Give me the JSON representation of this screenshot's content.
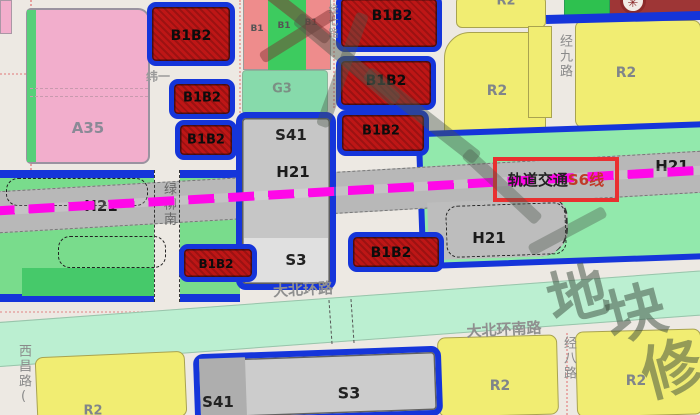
{
  "map_type": "urban-planning-zoning-map",
  "labels": {
    "a35": "A35",
    "b1b2": "B1B2",
    "b1": "B1",
    "g3": "G3",
    "s41": "S41",
    "h21": "H21",
    "s3": "S3",
    "r2": "R2"
  },
  "roads": {
    "wei_yi": "纬一",
    "jing_qi": "经七路",
    "jing_jiu": "经九路",
    "lv_liu": "绿柳南",
    "da_bei_huan": "大北环路",
    "da_bei_huan_nan": "大北环南路",
    "jing_ba": "经八路",
    "xi_chang": "西昌路("
  },
  "transit": {
    "prefix": "轨道交通",
    "line": "S6线"
  },
  "watermark": {
    "char_1": "地",
    "char_2": "块",
    "char_3": "修"
  },
  "icons": {
    "utility": "✳"
  },
  "colors": {
    "parcel_red": "#BE1616",
    "parcel_blue_border": "#1535DA",
    "rail_magenta": "#FF08E8",
    "highlight_red": "#E93030",
    "residential_yellow": "#F1ED72",
    "green_space": "#79DC8C",
    "corridor_gray": "#B8B8B8"
  }
}
